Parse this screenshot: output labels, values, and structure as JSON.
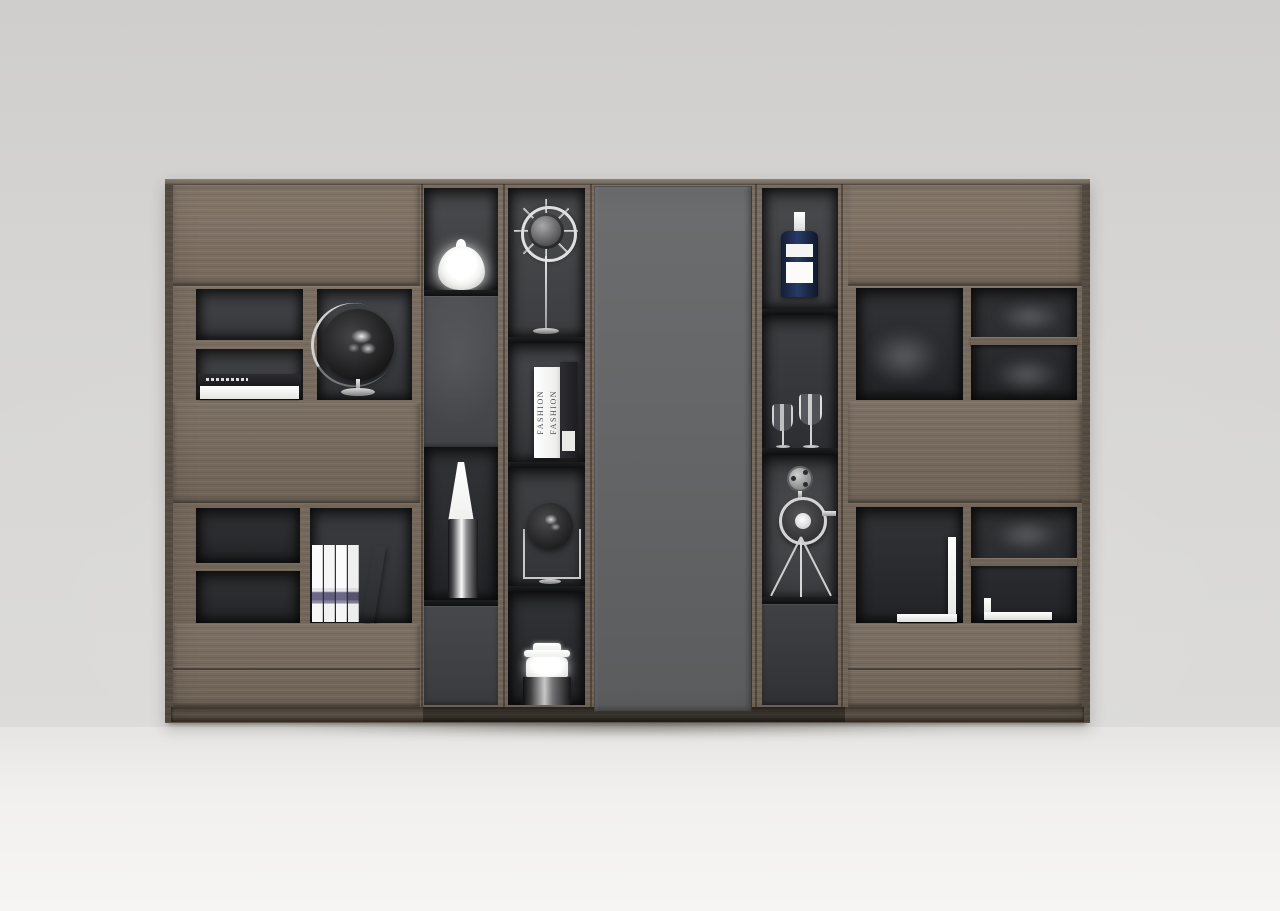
{
  "scene": {
    "type": "product-render",
    "description": "Modern modular wood wall bookshelf with dark grey display niches, center grey door and decorative objects",
    "palette": {
      "wall": "#d6d4d2",
      "floor": "#f1f0ee",
      "wood": "#75685b",
      "wood_light": "#83776a",
      "wood_dark": "#5a5146",
      "niche": "#3e3f42",
      "niche_dark": "#26272a",
      "door_gray": "#646667",
      "shelf_black": "#141517",
      "bottle_navy": "#1e2a4d",
      "object_white": "#ffffff"
    }
  },
  "cabinet": {
    "sections": [
      {
        "name": "left-hutch"
      },
      {
        "name": "display-column-1"
      },
      {
        "name": "display-column-2"
      },
      {
        "name": "center-door"
      },
      {
        "name": "display-column-3"
      },
      {
        "name": "right-hutch"
      }
    ]
  },
  "objects": {
    "white_vase": {
      "label": "white teardrop vase"
    },
    "ship_wheel": {
      "label": "ship wheel ornament on stand"
    },
    "desk_globe": {
      "label": "black world globe on metal stand"
    },
    "flat_books": {
      "label": "two stacked books"
    },
    "fashion_books": {
      "label": "standing fashion books",
      "spine_text": "FASHION",
      "spine_text_2": "FASHION"
    },
    "tall_bottle": {
      "label": "tall chrome bottle vase"
    },
    "mini_globe": {
      "label": "small globe in square stand"
    },
    "jar_vase": {
      "label": "chrome jar vase"
    },
    "blue_bottle": {
      "label": "navy bottle with white label"
    },
    "wine_glasses": {
      "label": "two stem glasses"
    },
    "film_camera": {
      "label": "vintage film camera on tripod"
    },
    "standing_books": {
      "label": "row of white books"
    },
    "bookends": {
      "label": "white metal bookends"
    }
  }
}
